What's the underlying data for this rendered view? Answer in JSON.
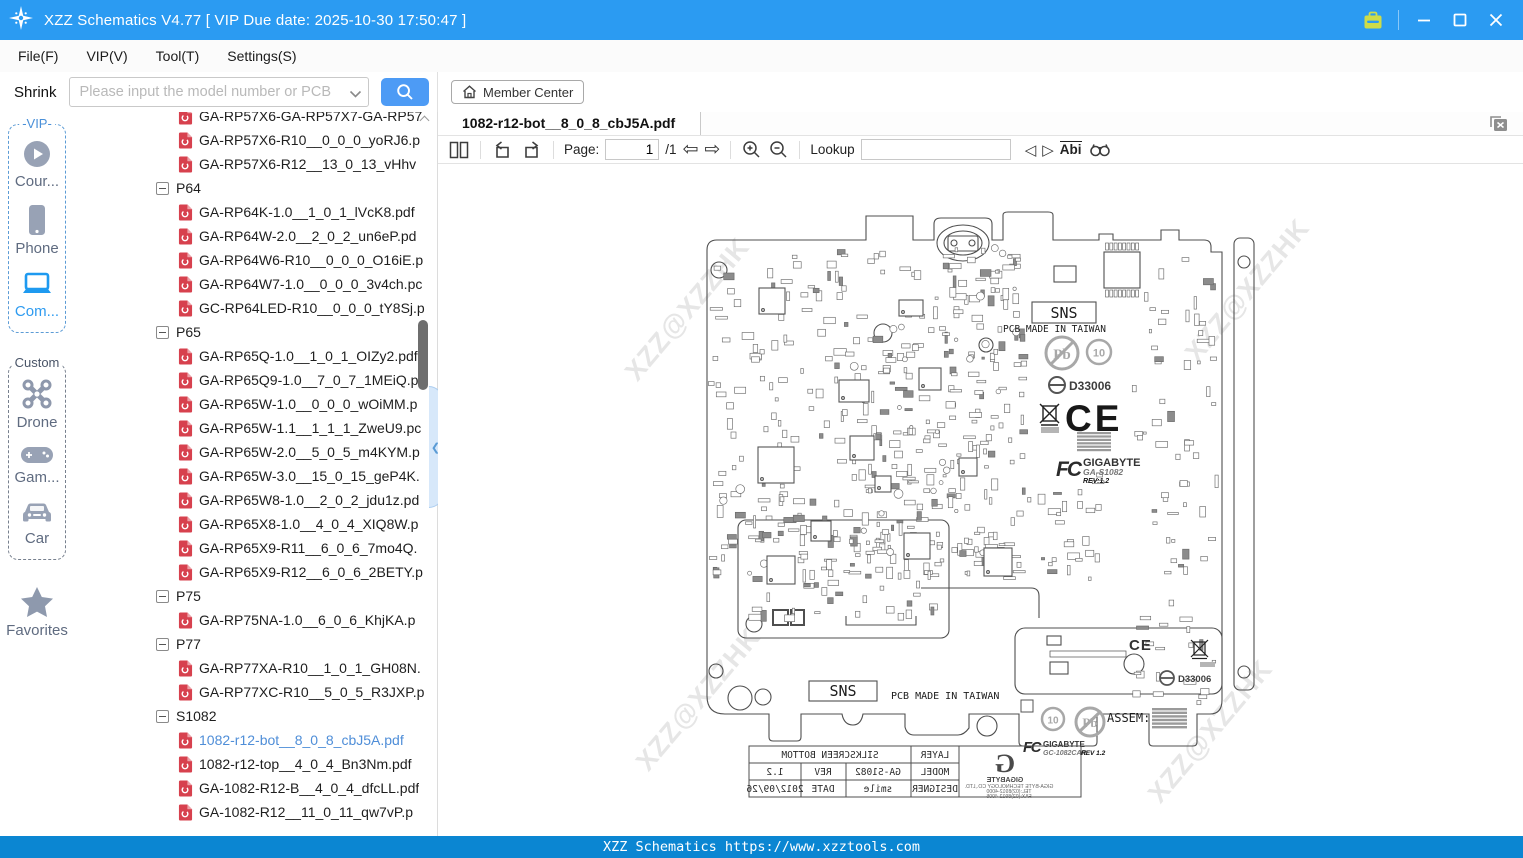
{
  "window": {
    "title": "XZZ Schematics V4.77 [ VIP Due date: 2025-10-30 17:50:47 ]"
  },
  "menu": {
    "items": [
      "File(F)",
      "VIP(V)",
      "Tool(T)",
      "Settings(S)"
    ]
  },
  "toolbar": {
    "shrink_label": "Shrink",
    "search_placeholder": "Please input the model number or PCB"
  },
  "sidebar": {
    "vip_label": "-VIP-",
    "vip_items": [
      {
        "icon": "play-circle",
        "label": "Cour..."
      },
      {
        "icon": "phone",
        "label": "Phone"
      },
      {
        "icon": "laptop",
        "label": "Com..."
      }
    ],
    "custom_label": "Custom",
    "custom_items": [
      {
        "icon": "drone",
        "label": "Drone"
      },
      {
        "icon": "gamepad",
        "label": "Gam..."
      },
      {
        "icon": "car",
        "label": "Car"
      }
    ],
    "favorites_label": "Favorites"
  },
  "tree": {
    "items": [
      {
        "type": "file",
        "label": "GA-RP57X6-GA-RP57X7-GA-RP57"
      },
      {
        "type": "file",
        "label": "GA-RP57X6-R10__0_0_0_yoRJ6.p"
      },
      {
        "type": "file",
        "label": "GA-RP57X6-R12__13_0_13_vHhv"
      },
      {
        "type": "group",
        "label": "P64"
      },
      {
        "type": "file",
        "label": "GA-RP64K-1.0__1_0_1_lVcK8.pdf"
      },
      {
        "type": "file",
        "label": "GA-RP64W-2.0__2_0_2_un6eP.pd"
      },
      {
        "type": "file",
        "label": "GA-RP64W6-R10__0_0_0_O16iE.p"
      },
      {
        "type": "file",
        "label": "GA-RP64W7-1.0__0_0_0_3v4ch.pc"
      },
      {
        "type": "file",
        "label": "GC-RP64LED-R10__0_0_0_tY8Sj.p"
      },
      {
        "type": "group",
        "label": "P65"
      },
      {
        "type": "file",
        "label": "GA-RP65Q-1.0__1_0_1_OIZy2.pdf"
      },
      {
        "type": "file",
        "label": "GA-RP65Q9-1.0__7_0_7_1MEiQ.p"
      },
      {
        "type": "file",
        "label": "GA-RP65W-1.0__0_0_0_wOiMM.p"
      },
      {
        "type": "file",
        "label": "GA-RP65W-1.1__1_1_1_ZweU9.pc"
      },
      {
        "type": "file",
        "label": "GA-RP65W-2.0__5_0_5_m4KYM.p"
      },
      {
        "type": "file",
        "label": "GA-RP65W-3.0__15_0_15_geP4K."
      },
      {
        "type": "file",
        "label": "GA-RP65W8-1.0__2_0_2_jdu1z.pd"
      },
      {
        "type": "file",
        "label": "GA-RP65X8-1.0__4_0_4_XIQ8W.p"
      },
      {
        "type": "file",
        "label": "GA-RP65X9-R11__6_0_6_7mo4Q."
      },
      {
        "type": "file",
        "label": "GA-RP65X9-R12__6_0_6_2BETY.p"
      },
      {
        "type": "group",
        "label": "P75"
      },
      {
        "type": "file",
        "label": "GA-RP75NA-1.0__6_0_6_KhjKA.p"
      },
      {
        "type": "group",
        "label": "P77"
      },
      {
        "type": "file",
        "label": "GA-RP77XA-R10__1_0_1_GH08N."
      },
      {
        "type": "file",
        "label": "GA-RP77XC-R10__5_0_5_R3JXP.p"
      },
      {
        "type": "group",
        "label": "S1082"
      },
      {
        "type": "file",
        "label": "1082-r12-bot__8_0_8_cbJ5A.pdf",
        "selected": true
      },
      {
        "type": "file",
        "label": "1082-r12-top__4_0_4_Bn3Nm.pdf"
      },
      {
        "type": "file",
        "label": "GA-1082-R12-B__4_0_4_dfcLL.pdf"
      },
      {
        "type": "file",
        "label": "GA-1082-R12__11_0_11_qw7vP.p"
      }
    ]
  },
  "viewer": {
    "member_center_label": "Member Center",
    "tab_title": "1082-r12-bot__8_0_8_cbJ5A.pdf",
    "toolbar": {
      "page_label": "Page:",
      "page_value": "1",
      "page_total": "/1",
      "lookup_label": "Lookup",
      "abi_label": "Abi"
    }
  },
  "pcb": {
    "watermark": "XZZ@XZZHK",
    "sns": "SNS",
    "made_in": "PCB MADE IN TAIWAN",
    "pb": "Pb",
    "ten": "10",
    "d33006": "D33006",
    "ce": "CE",
    "fcc_label": "FC",
    "assem": "ASSEM:",
    "top_block": {
      "brand": "GIGABYTE",
      "model": "GA-S1082",
      "rev": "REV:1.2"
    },
    "bottom_block": {
      "brand": "GIGABYTE",
      "model": "GC-1082CAR",
      "rev": "REV 1.2"
    },
    "titleblock": {
      "layer_label": "LAYER",
      "layer_value": "SILKSCREEN BOTTOM",
      "model_label": "MODEL",
      "model_value": "GA-S1082",
      "rev_label": "REV",
      "rev_value": "1.2",
      "designer_label": "DESIGNER",
      "designer_value": "smile",
      "date_label": "DATE",
      "date_value": "2012/09/26",
      "brand": "GIGABYTE",
      "company": "GIGA-BYTE TECHNOLOGY CO.,LTD.",
      "tel": "TEL:(02)8912-4000",
      "fax": "FAX:(02)8912-4005"
    }
  },
  "statusbar": {
    "text": "XZZ Schematics https://www.xzztools.com"
  }
}
